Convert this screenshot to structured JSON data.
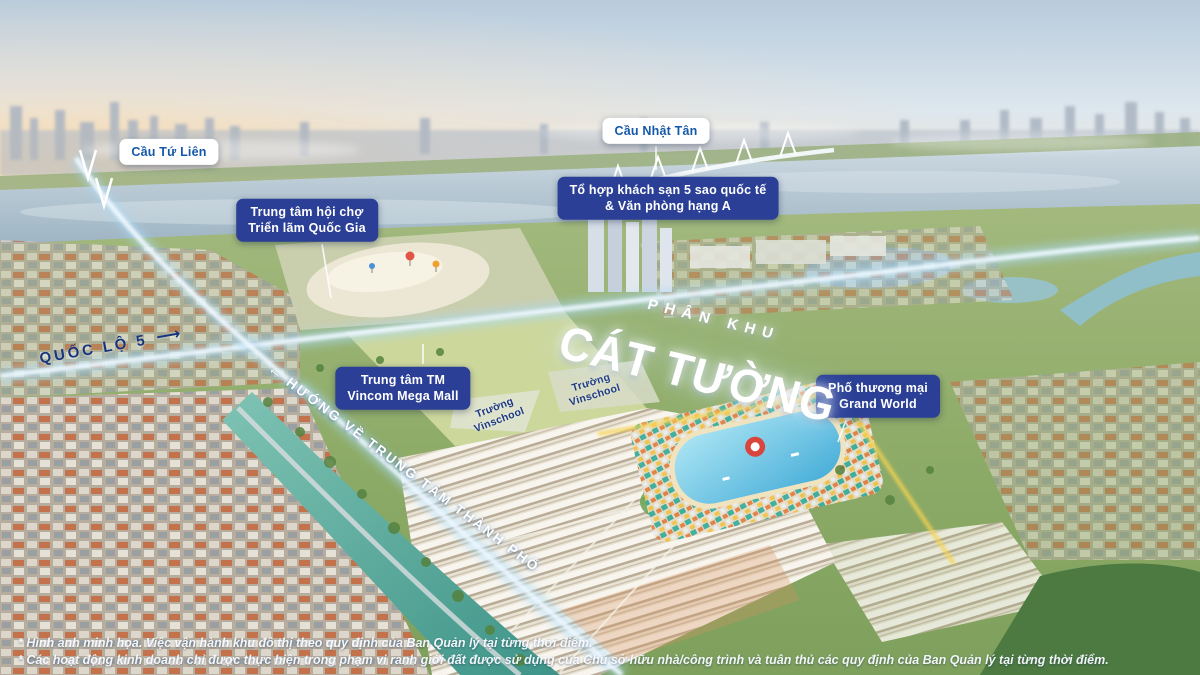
{
  "title": {
    "kicker": "PHÂN KHU",
    "name": "CÁT TƯỜNG"
  },
  "bridge_labels": {
    "tu_lien": "Cầu Tứ Liên",
    "nhat_tan": "Cầu Nhật Tân"
  },
  "landmark_labels": {
    "hotel_office": "Tổ hợp khách sạn 5 sao quốc tế\n& Văn phòng hạng A",
    "expo": "Trung tâm hội chợ\nTriển lãm Quốc Gia",
    "vincom": "Trung tâm TM\nVincom Mega Mall",
    "grand_world": "Phố thương mại\nGrand World",
    "vinschool_a": "Trường\nVinschool",
    "vinschool_b": "Trường\nVinschool"
  },
  "road_labels": {
    "quoc_lo_5": "QUỐC LỘ 5",
    "city_direction": "HƯỚNG VỀ TRUNG TÂM THÀNH PHỐ"
  },
  "icons": {
    "route_arrow_right": "⟶",
    "direction_arrow_left": "←"
  },
  "disclaimers": {
    "line1": "* Hình ảnh minh họa. Việc vận hành khu đô thị theo quy định của Ban Quản lý tại từng thời điểm.",
    "line2": "* Các hoạt động kinh doanh chỉ được thực hiện trong phạm vi ranh giới đất được sử dụng của Chủ sở hữu nhà/công trình và tuân thủ các quy định của Ban Quản lý tại từng thời điểm."
  },
  "colors": {
    "pill_blue": "#2a3f95",
    "white_pill_text_blue": "#1558a8",
    "road_text_navy": "#17357e",
    "road_glow_blue": "#a9d9f6",
    "canal_teal": "#3e9488",
    "lagoon_blue": "#44acd8",
    "accent_yellow_road": "#f6d352"
  }
}
